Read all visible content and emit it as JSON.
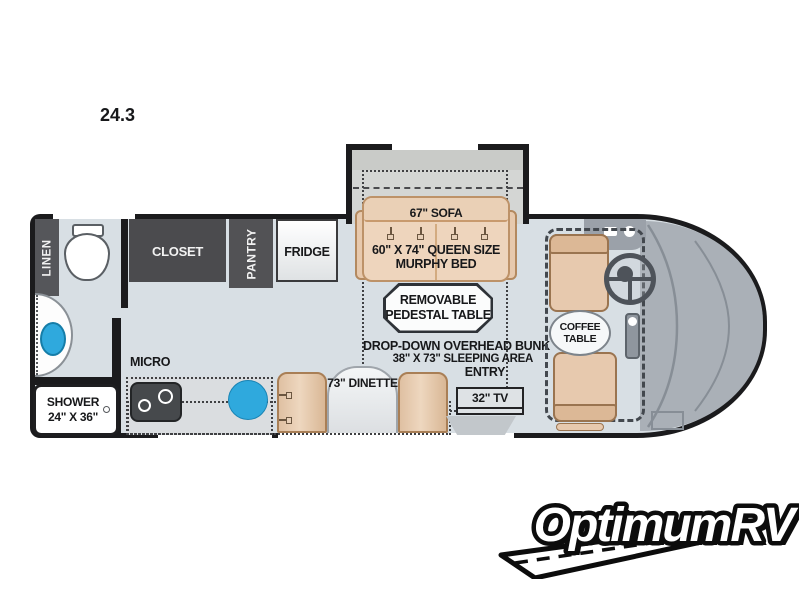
{
  "title": "24.3",
  "plan": {
    "linen": "LINEN",
    "closet": "CLOSET",
    "pantry": "PANTRY",
    "fridge": "FRIDGE",
    "sofa": "67\" SOFA",
    "murphy_bed": {
      "line1": "60\" X 74\" QUEEN SIZE",
      "line2": "MURPHY BED"
    },
    "pedestal_table": {
      "line1": "REMOVABLE",
      "line2": "PEDESTAL TABLE"
    },
    "overhead_bunk": {
      "line1": "DROP-DOWN OVERHEAD BUNK",
      "line2": "38\" X 73\" SLEEPING AREA"
    },
    "micro": "MICRO",
    "shower": {
      "line1": "SHOWER",
      "line2": "24\" X 36\""
    },
    "dinette": "73\" DINETTE",
    "entry": "ENTRY",
    "tv": "32\" TV",
    "coffee_table": {
      "line1": "COFFEE",
      "line2": "TABLE"
    }
  },
  "logo": {
    "text": "OptimumRV"
  },
  "colors": {
    "floor": "#d8dfe4",
    "wall": "#1b1b1d",
    "cabinet_dark": "#4e4e52",
    "furniture_tan": "#eed5bd",
    "sink_blue": "#2fa9dd",
    "cap_gray": "#aab0b7"
  }
}
